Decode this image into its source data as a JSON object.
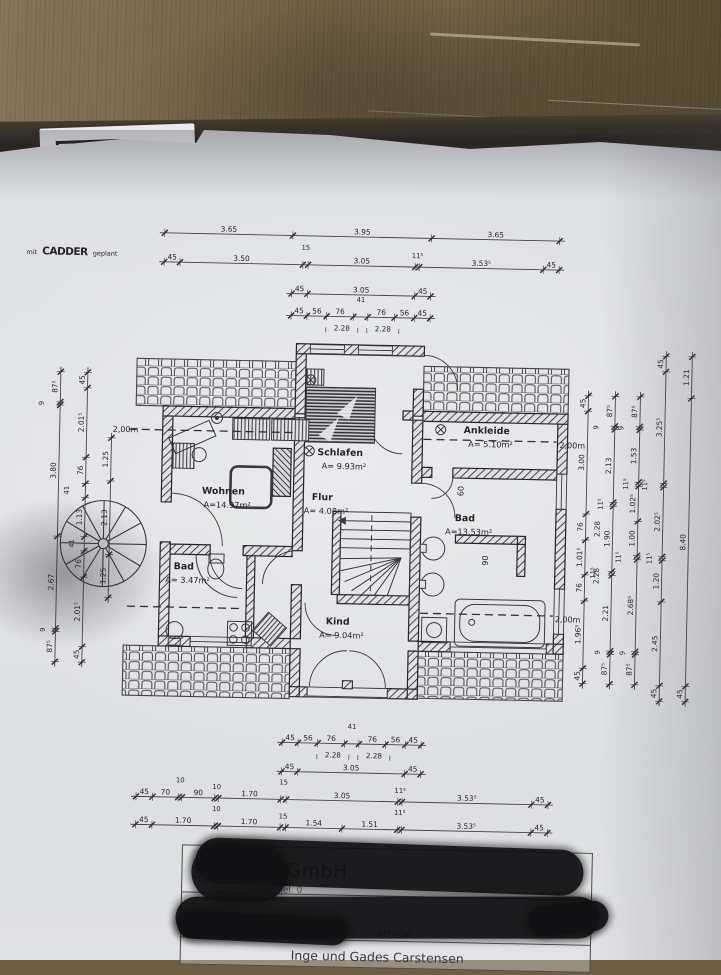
{
  "logo": {
    "prefix": "mit",
    "brand": "CADDER",
    "suffix": "geplant"
  },
  "plan": {
    "rooms": [
      {
        "name": "Schlafen",
        "area": "A=  9.93m²",
        "x": 338,
        "y": 456
      },
      {
        "name": "Ankleide",
        "area": "A=  5.10m²",
        "x": 484,
        "y": 431
      },
      {
        "name": "Wohnen",
        "area": "A=14.97m²",
        "x": 222,
        "y": 497
      },
      {
        "name": "Flur",
        "area": "A=  4.08m²",
        "x": 321,
        "y": 501
      },
      {
        "name": "Bad",
        "area": "A=13.53m²",
        "x": 464,
        "y": 519
      },
      {
        "name": "Bad",
        "area": "A= 3.47m²",
        "x": 184,
        "y": 573
      },
      {
        "name": "Kind",
        "area": "A=  9.04m²",
        "x": 339,
        "y": 625
      }
    ],
    "chains": [
      {
        "o": "h",
        "c": 237,
        "a": 158,
        "b": 553,
        "segs": [
          {
            "t": "3.65",
            "w": 365
          },
          {
            "t": "3.95",
            "w": 395
          },
          {
            "t": "3.65",
            "w": 365
          }
        ]
      },
      {
        "o": "h",
        "c": 266,
        "a": 158,
        "b": 553,
        "segs": [
          {
            "t": "45",
            "w": 45
          },
          {
            "t": "3.50",
            "w": 350
          },
          {
            "t": "15",
            "w": 15
          },
          {
            "t": "3.05",
            "w": 305
          },
          {
            "t": "11⁵",
            "w": 11.5
          },
          {
            "t": "3.53⁵",
            "w": 353.5
          },
          {
            "t": "45",
            "w": 45
          }
        ]
      },
      {
        "o": "h",
        "c": 295,
        "a": 286,
        "b": 425,
        "segs": [
          {
            "t": "45",
            "w": 45
          },
          {
            "t": "3.05",
            "w": 305
          },
          {
            "t": "45",
            "w": 45
          }
        ]
      },
      {
        "o": "h",
        "c": 317,
        "a": 286,
        "b": 425,
        "segs": [
          {
            "t": "45",
            "w": 45
          },
          {
            "t": "56",
            "w": 56
          },
          {
            "t": "76",
            "w": 76
          },
          {
            "t": "41",
            "w": 41
          },
          {
            "t": "76",
            "w": 76
          },
          {
            "t": "56",
            "w": 56
          },
          {
            "t": "45",
            "w": 45
          }
        ]
      },
      {
        "o": "h",
        "c": 744,
        "a": 286,
        "b": 425,
        "segs": [
          {
            "t": "45",
            "w": 45
          },
          {
            "t": "56",
            "w": 56
          },
          {
            "t": "76",
            "w": 76
          },
          {
            "t": "41",
            "w": 41
          },
          {
            "t": "76",
            "w": 76
          },
          {
            "t": "56",
            "w": 56
          },
          {
            "t": "45",
            "w": 45
          }
        ]
      },
      {
        "o": "h",
        "c": 773,
        "a": 286,
        "b": 425,
        "segs": [
          {
            "t": "45",
            "w": 45
          },
          {
            "t": "3.05",
            "w": 305
          },
          {
            "t": "45",
            "w": 45
          }
        ]
      },
      {
        "o": "h",
        "c": 801,
        "a": 141,
        "b": 553,
        "segs": [
          {
            "t": "45",
            "w": 45
          },
          {
            "t": "70",
            "w": 70
          },
          {
            "t": "10",
            "w": 10
          },
          {
            "t": "90",
            "w": 90
          },
          {
            "t": "10",
            "w": 10
          },
          {
            "t": "1.70",
            "w": 170
          },
          {
            "t": "15",
            "w": 15
          },
          {
            "t": "3.05",
            "w": 305
          },
          {
            "t": "11⁵",
            "w": 11.5
          },
          {
            "t": "3.53⁵",
            "w": 353.5
          },
          {
            "t": "45",
            "w": 45
          }
        ]
      },
      {
        "o": "h",
        "c": 829,
        "a": 141,
        "b": 553,
        "segs": [
          {
            "t": "45",
            "w": 45
          },
          {
            "t": "1.70",
            "w": 170
          },
          {
            "t": "10",
            "w": 10
          },
          {
            "t": "1.70",
            "w": 170
          },
          {
            "t": "15",
            "w": 15
          },
          {
            "t": "1.54",
            "w": 154
          },
          {
            "t": "1.51",
            "w": 151
          },
          {
            "t": "11⁵",
            "w": 11.5
          },
          {
            "t": "3.53⁵",
            "w": 353.5
          },
          {
            "t": "45",
            "w": 45
          }
        ]
      },
      {
        "o": "v",
        "c": 57,
        "a": 378,
        "b": 668,
        "segs": [
          {
            "t": "87⁵",
            "w": 87.5
          },
          {
            "t": "9",
            "w": 9
          },
          {
            "t": "3.80",
            "w": 380
          },
          {
            "t": "2.67",
            "w": 267
          },
          {
            "t": "9",
            "w": 9
          },
          {
            "t": "87⁵",
            "w": 87.5
          }
        ]
      },
      {
        "o": "v",
        "c": 84,
        "a": 378,
        "b": 668,
        "segs": [
          {
            "t": "45",
            "w": 45
          },
          {
            "t": "2.01⁵",
            "w": 201.5
          },
          {
            "t": "76",
            "w": 76
          },
          {
            "t": "41",
            "w": 41
          },
          {
            "t": "1.13",
            "w": 113
          },
          {
            "t": "41",
            "w": 41
          },
          {
            "t": "76",
            "w": 76
          },
          {
            "t": "2.01⁵",
            "w": 201.5
          },
          {
            "t": "45",
            "w": 45
          }
        ]
      },
      {
        "o": "v",
        "c": 109,
        "a": 443,
        "b": 603,
        "segs": [
          {
            "t": "1.25",
            "w": 125
          },
          {
            "t": "2.13",
            "w": 213
          },
          {
            "t": "1.25",
            "w": 125
          }
        ]
      },
      {
        "o": "v",
        "c": 585,
        "a": 391,
        "b": 679,
        "segs": [
          {
            "t": "45",
            "w": 45
          },
          {
            "t": "3.00",
            "w": 300
          },
          {
            "t": "76",
            "w": 76
          },
          {
            "t": "1.01⁵",
            "w": 101.5
          },
          {
            "t": "76",
            "w": 76
          },
          {
            "t": "1.96⁵",
            "w": 196.5
          },
          {
            "t": "45",
            "w": 45
          }
        ]
      },
      {
        "o": "v",
        "c": 612,
        "a": 391,
        "b": 679,
        "segs": [
          {
            "t": "87⁵",
            "w": 87.5
          },
          {
            "t": "9",
            "w": 9
          },
          {
            "t": "2.13",
            "w": 213
          },
          {
            "t": "11⁵",
            "w": 11.5
          },
          {
            "t": "1.90",
            "w": 190
          },
          {
            "t": "11⁵",
            "w": 11.5
          },
          {
            "t": "2.21",
            "w": 221
          },
          {
            "t": "9",
            "w": 9
          },
          {
            "t": "87⁵",
            "w": 87.5
          }
        ]
      },
      {
        "o": "v",
        "c": 637,
        "a": 391,
        "b": 679,
        "segs": [
          {
            "t": "87⁵",
            "w": 87.5
          },
          {
            "t": "9",
            "w": 9
          },
          {
            "t": "1.53",
            "w": 153
          },
          {
            "t": "11⁵",
            "w": 11.5
          },
          {
            "t": "1.02⁵",
            "w": 102.5
          },
          {
            "t": "1.00",
            "w": 100
          },
          {
            "t": "11⁵",
            "w": 11.5
          },
          {
            "t": "2.68⁵",
            "w": 268.5
          },
          {
            "t": "9",
            "w": 9
          },
          {
            "t": "87⁵",
            "w": 87.5
          }
        ]
      },
      {
        "o": "v",
        "c": 662,
        "a": 350,
        "b": 695,
        "segs": [
          {
            "t": "45",
            "w": 45
          },
          {
            "t": "3.25⁵",
            "w": 325.5
          },
          {
            "t": "11⁵",
            "w": 11.5
          },
          {
            "t": "2.02⁵",
            "w": 202.5
          },
          {
            "t": "11⁵",
            "w": 11.5
          },
          {
            "t": "1.20",
            "w": 120
          },
          {
            "t": "2.45",
            "w": 245
          },
          {
            "t": "45",
            "w": 45
          }
        ]
      },
      {
        "o": "v",
        "c": 688,
        "a": 350,
        "b": 695,
        "segs": [
          {
            "t": "1.21",
            "w": 121
          },
          {
            "t": "8.40",
            "w": 840
          },
          {
            "t": "45",
            "w": 45
          }
        ]
      }
    ],
    "subs": [
      {
        "t": "2.28",
        "x": 337,
        "y": 331
      },
      {
        "t": "2.28",
        "x": 378,
        "y": 331
      },
      {
        "t": "2.28",
        "x": 337,
        "y": 758
      },
      {
        "t": "2.28",
        "x": 378,
        "y": 758
      },
      {
        "t": "2.28",
        "x": 599,
        "y": 524,
        "r": -90
      },
      {
        "t": "2.28",
        "x": 599,
        "y": 571,
        "r": -90
      }
    ],
    "marks": [
      {
        "t": "2,00m",
        "x": 110,
        "y": 437
      },
      {
        "t": "2,00m",
        "x": 557,
        "y": 444
      },
      {
        "t": "2,00m",
        "x": 556,
        "y": 618
      },
      {
        "t": "60",
        "x": 462,
        "y": 489,
        "r": -90
      },
      {
        "t": "90",
        "x": 488,
        "y": 558,
        "r": -90
      }
    ]
  },
  "title_block": {
    "company_fragment": "bau GmbH",
    "address_fragment": "stedt,  Tel. 0",
    "label_bauort": "Bauort:",
    "street_fragment": "straße",
    "builder": "Inge und Gades Carstensen"
  }
}
